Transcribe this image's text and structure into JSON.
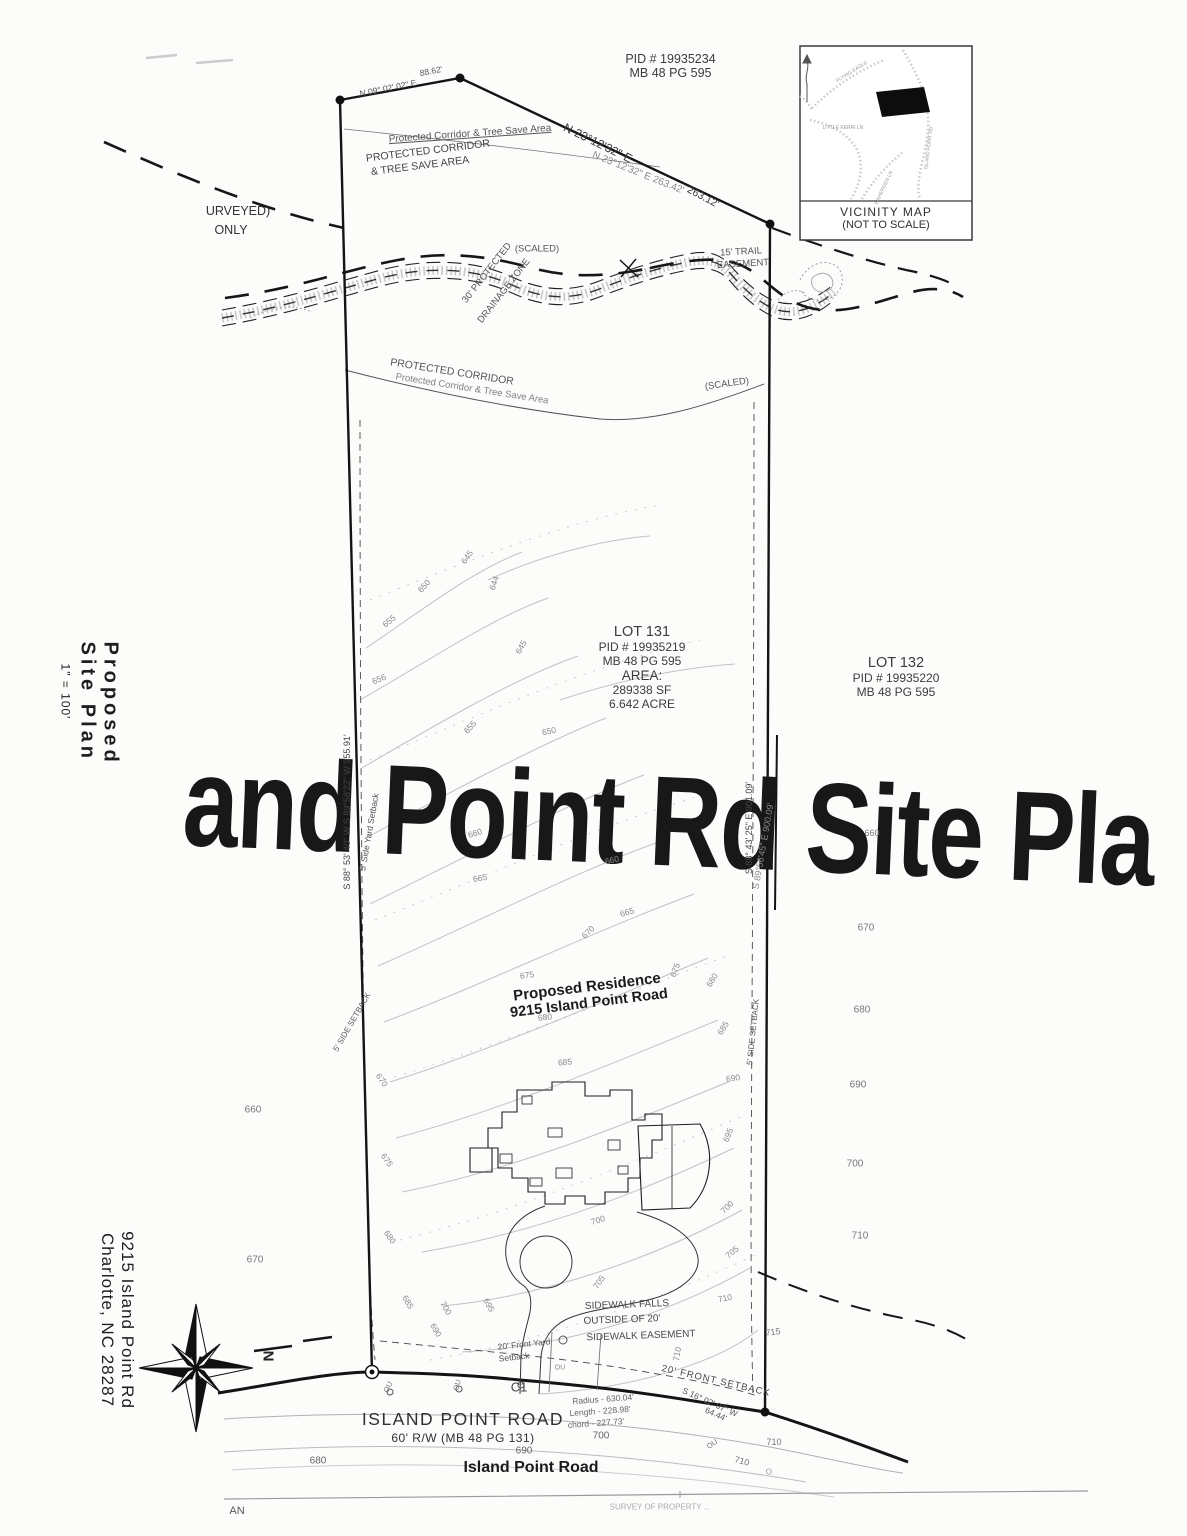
{
  "watermark": {
    "text": "and Point Rd Site Pla"
  },
  "sidebar": {
    "title_line1": "Proposed",
    "title_line2": "Site Plan",
    "scale": "1\" = 100'",
    "address_line1": "9215 Island Point Rd",
    "address_line2": "Charlotte,  NC 28287"
  },
  "vicinity": {
    "title": "VICINITY MAP",
    "subtitle": "(NOT TO SCALE)"
  },
  "parcel_top": {
    "pid": "PID # 19935234",
    "map_book": "MB 48 PG 595"
  },
  "lot131": {
    "name": "LOT 131",
    "pid": "PID # 19935219",
    "map_book": "MB 48 PG 595",
    "area_label": "AREA:",
    "area_sf": "289338 SF",
    "area_acres": "6.642 ACRE"
  },
  "lot132": {
    "name": "LOT 132",
    "pid": "PID # 19935220",
    "map_book": "MB 48 PG 595"
  },
  "residence": {
    "line1": "Proposed Residence",
    "line2": "9215 Island Point Road"
  },
  "road": {
    "name_caps": "ISLAND POINT ROAD",
    "right_of_way": "60' R/W (MB 48 PG 131)",
    "name_bold": "Island Point Road"
  },
  "compass": {
    "north": "N"
  },
  "annotations": [
    {
      "n": "surveyed-note-1",
      "t": "URVEYED)",
      "x": 238,
      "y": 211,
      "fs": 12.5,
      "c": "#333"
    },
    {
      "n": "surveyed-note-2",
      "t": "ONLY",
      "x": 231,
      "y": 230,
      "fs": 12.5,
      "c": "#333"
    },
    {
      "n": "tree-save-label-top-script",
      "t": "Protected Corridor & Tree Save Area",
      "x": 470,
      "y": 134,
      "r": -4,
      "fs": 10,
      "c": "#555",
      "u": 1
    },
    {
      "n": "tree-save-label-top-1",
      "t": "PROTECTED CORRIDOR",
      "x": 428,
      "y": 151,
      "r": -7,
      "fs": 10.5,
      "c": "#444"
    },
    {
      "n": "tree-save-label-top-2",
      "t": "& TREE SAVE AREA",
      "x": 420,
      "y": 166,
      "r": -7,
      "fs": 10.5,
      "c": "#444"
    },
    {
      "n": "bearing-top-left",
      "t": "N 09° 02' 02\" E",
      "x": 388,
      "y": 88,
      "r": -11,
      "fs": 8.5,
      "c": "#555"
    },
    {
      "n": "distance-top-left",
      "t": "88.62'",
      "x": 431,
      "y": 71,
      "r": -11,
      "fs": 8.5,
      "c": "#555"
    },
    {
      "n": "bearing-top-right",
      "t": "N 23°12'32\" E",
      "x": 598,
      "y": 143,
      "r": 26,
      "fs": 12,
      "c": "#3a3a3a"
    },
    {
      "n": "bearing-top-right-ghost",
      "t": "N 23°12'32\" E  263.42'",
      "x": 638,
      "y": 173,
      "r": 22,
      "fs": 10,
      "c": "#8a8a8a"
    },
    {
      "n": "distance-top-right",
      "t": "263.12'",
      "x": 703,
      "y": 197,
      "r": 28,
      "fs": 10.5,
      "c": "#3a3a3a"
    },
    {
      "n": "scaled-label-1",
      "t": "(SCALED)",
      "x": 537,
      "y": 249,
      "fs": 9.5,
      "c": "#555"
    },
    {
      "n": "trail-easement-1",
      "t": "15' TRAIL",
      "x": 741,
      "y": 252,
      "r": -3,
      "fs": 9.5,
      "c": "#555"
    },
    {
      "n": "trail-easement-2",
      "t": "EASEMENT",
      "x": 743,
      "y": 264,
      "r": -3,
      "fs": 9.5,
      "c": "#555"
    },
    {
      "n": "drainage-zone-1",
      "t": "30' PROTECTED",
      "x": 487,
      "y": 273,
      "r": -52,
      "fs": 9.5,
      "c": "#555"
    },
    {
      "n": "drainage-zone-2",
      "t": "DRAINAGE ZONE",
      "x": 504,
      "y": 291,
      "r": -52,
      "fs": 9.5,
      "c": "#555"
    },
    {
      "n": "tree-save-label-mid-1",
      "t": "PROTECTED CORRIDOR",
      "x": 452,
      "y": 372,
      "r": 9,
      "fs": 10.5,
      "c": "#555"
    },
    {
      "n": "tree-save-label-mid-ghost",
      "t": "Protected Corridor & Tree Save Area",
      "x": 472,
      "y": 389,
      "r": 9,
      "fs": 9.5,
      "c": "#808080"
    },
    {
      "n": "scaled-label-2",
      "t": "(SCALED)",
      "x": 727,
      "y": 384,
      "r": -8,
      "fs": 9.5,
      "c": "#555"
    },
    {
      "n": "bearing-left-boundary",
      "t": "S 88° 53' 40\" W  S 89°58'22\" W  955.91'",
      "x": 347,
      "y": 812,
      "r": -90,
      "fs": 9,
      "c": "#444"
    },
    {
      "n": "bearing-right-boundary",
      "t": "S 88° 43' 25\" E      901.09'",
      "x": 749,
      "y": 828,
      "r": -90,
      "fs": 9,
      "c": "#444"
    },
    {
      "n": "bearing-right-boundary-ghost",
      "t": "S 89°56'45\" E  900.09'",
      "x": 763,
      "y": 846,
      "r": -80,
      "fs": 9,
      "c": "#8a8a8a"
    },
    {
      "n": "side-setback-left-1",
      "t": "5' Side Yard Setback",
      "x": 369,
      "y": 832,
      "r": -80,
      "fs": 8.5,
      "c": "#555"
    },
    {
      "n": "side-setback-left-2",
      "t": "5' SIDE SETBACK",
      "x": 352,
      "y": 1022,
      "r": -60,
      "fs": 8,
      "c": "#555"
    },
    {
      "n": "side-setback-right",
      "t": "5' SIDE SETBACK",
      "x": 753,
      "y": 1032,
      "r": -84,
      "fs": 8,
      "c": "#555"
    },
    {
      "n": "sidewalk-note-1",
      "t": "SIDEWALK FALLS",
      "x": 627,
      "y": 1305,
      "r": -2,
      "fs": 10,
      "c": "#4a4a4a"
    },
    {
      "n": "sidewalk-note-2",
      "t": "OUTSIDE OF 20'",
      "x": 622,
      "y": 1320,
      "r": -2,
      "fs": 10,
      "c": "#4a4a4a"
    },
    {
      "n": "sidewalk-note-3",
      "t": "SIDEWALK EASEMENT",
      "x": 641,
      "y": 1336,
      "r": -2,
      "fs": 10,
      "c": "#4a4a4a"
    },
    {
      "n": "front-setback-left-1",
      "t": "20' Front Yard",
      "x": 524,
      "y": 1344,
      "r": -6,
      "fs": 8.5,
      "c": "#555"
    },
    {
      "n": "front-setback-left-2",
      "t": "Setback",
      "x": 514,
      "y": 1357,
      "r": -6,
      "fs": 8.5,
      "c": "#555"
    },
    {
      "n": "curve-label",
      "t": "C1",
      "x": 519,
      "y": 1387,
      "fs": 13,
      "c": "#444"
    },
    {
      "n": "curve-radius",
      "t": "Radius - 630.04'",
      "x": 603,
      "y": 1399,
      "r": -4,
      "fs": 8.5,
      "c": "#666"
    },
    {
      "n": "curve-length",
      "t": "Length - 228.98'",
      "x": 600,
      "y": 1411,
      "r": -4,
      "fs": 8.5,
      "c": "#666"
    },
    {
      "n": "curve-chord",
      "t": "chord - 227.73'",
      "x": 596,
      "y": 1423,
      "r": -4,
      "fs": 8.5,
      "c": "#666"
    },
    {
      "n": "front-setback-right",
      "t": "20' FRONT SETBACK",
      "x": 716,
      "y": 1381,
      "r": 13,
      "fs": 9.5,
      "c": "#4a4a4a",
      "ls": 1
    },
    {
      "n": "bearing-bottom-right-1",
      "t": "S 16° 02' 07\" W",
      "x": 710,
      "y": 1402,
      "r": 24,
      "fs": 8.5,
      "c": "#555"
    },
    {
      "n": "bearing-bottom-right-2",
      "t": "64.44'",
      "x": 716,
      "y": 1414,
      "r": 24,
      "fs": 8.5,
      "c": "#555"
    },
    {
      "n": "road-partial-an",
      "t": "AN",
      "x": 237,
      "y": 1511,
      "fs": 11,
      "c": "#555"
    },
    {
      "n": "survey-partial",
      "t": "SURVEY OF PROPERTY ...",
      "x": 660,
      "y": 1507,
      "fs": 8,
      "c": "#aaa"
    },
    {
      "n": "utility-label",
      "t": "OU",
      "x": 388,
      "y": 1387,
      "r": -65,
      "fs": 7.5,
      "c": "#777"
    },
    {
      "n": "utility-label",
      "t": "OU",
      "x": 457,
      "y": 1385,
      "r": -75,
      "fs": 7.5,
      "c": "#777"
    },
    {
      "n": "utility-label",
      "t": "OU",
      "x": 560,
      "y": 1368,
      "fs": 7,
      "c": "#888"
    },
    {
      "n": "utility-label",
      "t": "OU",
      "x": 712,
      "y": 1444,
      "r": -35,
      "fs": 7.5,
      "c": "#777"
    },
    {
      "n": "contour-label",
      "t": "645",
      "x": 467,
      "y": 557,
      "r": -55,
      "fs": 8.5,
      "c": "#8a8a8a"
    },
    {
      "n": "contour-label",
      "t": "650",
      "x": 424,
      "y": 586,
      "r": -48,
      "fs": 8.5,
      "c": "#8a8a8a"
    },
    {
      "n": "contour-label",
      "t": "644",
      "x": 494,
      "y": 583,
      "r": -72,
      "fs": 8.5,
      "c": "#8a8a8a"
    },
    {
      "n": "contour-label",
      "t": "655",
      "x": 389,
      "y": 621,
      "r": -40,
      "fs": 8.5,
      "c": "#8a8a8a"
    },
    {
      "n": "contour-label",
      "t": "656",
      "x": 379,
      "y": 679,
      "r": -22,
      "fs": 8.5,
      "c": "#8a8a8a"
    },
    {
      "n": "contour-label",
      "t": "645",
      "x": 521,
      "y": 647,
      "r": -60,
      "fs": 8.5,
      "c": "#8a8a8a"
    },
    {
      "n": "contour-label",
      "t": "650",
      "x": 549,
      "y": 731,
      "r": -12,
      "fs": 8.5,
      "c": "#8a8a8a"
    },
    {
      "n": "contour-label",
      "t": "655",
      "x": 470,
      "y": 727,
      "r": -48,
      "fs": 8.5,
      "c": "#8a8a8a"
    },
    {
      "n": "contour-label",
      "t": "660",
      "x": 475,
      "y": 833,
      "r": -18,
      "fs": 8.5,
      "c": "#8a8a8a"
    },
    {
      "n": "contour-label",
      "t": "660",
      "x": 612,
      "y": 860,
      "r": -14,
      "fs": 8.5,
      "c": "#8a8a8a"
    },
    {
      "n": "contour-label",
      "t": "665",
      "x": 480,
      "y": 878,
      "r": -10,
      "fs": 8.5,
      "c": "#8a8a8a"
    },
    {
      "n": "contour-label",
      "t": "665",
      "x": 627,
      "y": 912,
      "r": -16,
      "fs": 8.5,
      "c": "#8a8a8a"
    },
    {
      "n": "contour-label",
      "t": "670",
      "x": 588,
      "y": 932,
      "r": -45,
      "fs": 8.5,
      "c": "#8a8a8a"
    },
    {
      "n": "contour-label",
      "t": "675",
      "x": 527,
      "y": 975,
      "r": -8,
      "fs": 8.5,
      "c": "#8a8a8a"
    },
    {
      "n": "contour-label",
      "t": "675",
      "x": 675,
      "y": 970,
      "r": -70,
      "fs": 8.5,
      "c": "#8a8a8a"
    },
    {
      "n": "contour-label",
      "t": "680",
      "x": 712,
      "y": 980,
      "r": -58,
      "fs": 8.5,
      "c": "#8a8a8a"
    },
    {
      "n": "contour-label",
      "t": "680",
      "x": 545,
      "y": 1017,
      "r": -6,
      "fs": 8.5,
      "c": "#8a8a8a"
    },
    {
      "n": "contour-label",
      "t": "685",
      "x": 565,
      "y": 1062,
      "r": -5,
      "fs": 8.5,
      "c": "#8a8a8a"
    },
    {
      "n": "contour-label",
      "t": "685",
      "x": 723,
      "y": 1028,
      "r": -58,
      "fs": 8.5,
      "c": "#8a8a8a"
    },
    {
      "n": "contour-label",
      "t": "690",
      "x": 733,
      "y": 1078,
      "r": -8,
      "fs": 8.5,
      "c": "#8a8a8a"
    },
    {
      "n": "contour-label",
      "t": "695",
      "x": 728,
      "y": 1135,
      "r": -68,
      "fs": 8.5,
      "c": "#8a8a8a"
    },
    {
      "n": "contour-label",
      "t": "700",
      "x": 598,
      "y": 1220,
      "r": -18,
      "fs": 8.5,
      "c": "#8a8a8a"
    },
    {
      "n": "contour-label",
      "t": "700",
      "x": 727,
      "y": 1207,
      "r": -45,
      "fs": 8.5,
      "c": "#8a8a8a"
    },
    {
      "n": "contour-label",
      "t": "705",
      "x": 732,
      "y": 1252,
      "r": -40,
      "fs": 8.5,
      "c": "#8a8a8a"
    },
    {
      "n": "contour-label",
      "t": "705",
      "x": 599,
      "y": 1282,
      "r": -55,
      "fs": 8.5,
      "c": "#8a8a8a"
    },
    {
      "n": "contour-label",
      "t": "710",
      "x": 725,
      "y": 1298,
      "r": -12,
      "fs": 8.5,
      "c": "#8a8a8a"
    },
    {
      "n": "contour-label",
      "t": "710",
      "x": 677,
      "y": 1354,
      "r": -80,
      "fs": 8.5,
      "c": "#8a8a8a"
    },
    {
      "n": "contour-label",
      "t": "715",
      "x": 773,
      "y": 1332,
      "r": -8,
      "fs": 9,
      "c": "#777"
    },
    {
      "n": "contour-label",
      "t": "670",
      "x": 382,
      "y": 1080,
      "r": 55,
      "fs": 8.5,
      "c": "#8a8a8a"
    },
    {
      "n": "contour-label",
      "t": "675",
      "x": 387,
      "y": 1160,
      "r": 55,
      "fs": 8.5,
      "c": "#8a8a8a"
    },
    {
      "n": "contour-label",
      "t": "680",
      "x": 390,
      "y": 1237,
      "r": 55,
      "fs": 8.5,
      "c": "#8a8a8a"
    },
    {
      "n": "contour-label",
      "t": "685",
      "x": 408,
      "y": 1302,
      "r": 60,
      "fs": 8.5,
      "c": "#8a8a8a"
    },
    {
      "n": "contour-label",
      "t": "690",
      "x": 436,
      "y": 1330,
      "r": 60,
      "fs": 8.5,
      "c": "#8a8a8a"
    },
    {
      "n": "contour-label",
      "t": "695",
      "x": 489,
      "y": 1305,
      "r": 60,
      "fs": 8.5,
      "c": "#8a8a8a"
    },
    {
      "n": "contour-label",
      "t": "700",
      "x": 446,
      "y": 1308,
      "r": 60,
      "fs": 8.5,
      "c": "#8a8a8a"
    },
    {
      "n": "contour-label",
      "t": "660",
      "x": 872,
      "y": 833,
      "r": 0,
      "fs": 9,
      "c": "#777"
    },
    {
      "n": "contour-label",
      "t": "670",
      "x": 866,
      "y": 928,
      "r": 0,
      "fs": 10,
      "c": "#777"
    },
    {
      "n": "contour-label",
      "t": "680",
      "x": 862,
      "y": 1010,
      "r": 0,
      "fs": 10,
      "c": "#777"
    },
    {
      "n": "contour-label",
      "t": "690",
      "x": 858,
      "y": 1085,
      "r": 0,
      "fs": 10,
      "c": "#777"
    },
    {
      "n": "contour-label",
      "t": "700",
      "x": 855,
      "y": 1164,
      "r": 0,
      "fs": 10,
      "c": "#777"
    },
    {
      "n": "contour-label",
      "t": "710",
      "x": 860,
      "y": 1236,
      "r": 0,
      "fs": 10,
      "c": "#777"
    },
    {
      "n": "contour-label",
      "t": "660",
      "x": 253,
      "y": 1110,
      "r": 0,
      "fs": 10,
      "c": "#777"
    },
    {
      "n": "contour-label",
      "t": "670",
      "x": 255,
      "y": 1260,
      "r": 0,
      "fs": 10,
      "c": "#777"
    },
    {
      "n": "contour-label",
      "t": "680",
      "x": 318,
      "y": 1461,
      "r": 0,
      "fs": 10,
      "c": "#666"
    },
    {
      "n": "contour-label",
      "t": "690",
      "x": 524,
      "y": 1451,
      "r": 0,
      "fs": 10,
      "c": "#666"
    },
    {
      "n": "contour-label",
      "t": "700",
      "x": 601,
      "y": 1436,
      "r": 0,
      "fs": 10,
      "c": "#666"
    },
    {
      "n": "contour-label",
      "t": "710",
      "x": 774,
      "y": 1442,
      "r": 0,
      "fs": 9,
      "c": "#777"
    },
    {
      "n": "contour-label",
      "t": "710",
      "x": 742,
      "y": 1461,
      "r": 15,
      "fs": 9,
      "c": "#777"
    },
    {
      "n": "contour-label",
      "t": "O.",
      "x": 770,
      "y": 1472,
      "r": 0,
      "fs": 8,
      "c": "#999"
    },
    {
      "n": "vicinity-road-label",
      "t": "FLYING EAGLE",
      "x": 852,
      "y": 72,
      "r": -32,
      "fs": 5,
      "c": "#999"
    },
    {
      "n": "vicinity-road-label",
      "t": "ISLAND POINT RD",
      "x": 929,
      "y": 148,
      "r": -83,
      "fs": 5,
      "c": "#999"
    },
    {
      "n": "vicinity-road-label",
      "t": "LITTLE KERRI LN",
      "x": 843,
      "y": 128,
      "r": 0,
      "fs": 5,
      "c": "#999"
    },
    {
      "n": "vicinity-road-label",
      "t": "WAHERDEN LN",
      "x": 884,
      "y": 188,
      "r": -65,
      "fs": 5,
      "c": "#999"
    }
  ]
}
